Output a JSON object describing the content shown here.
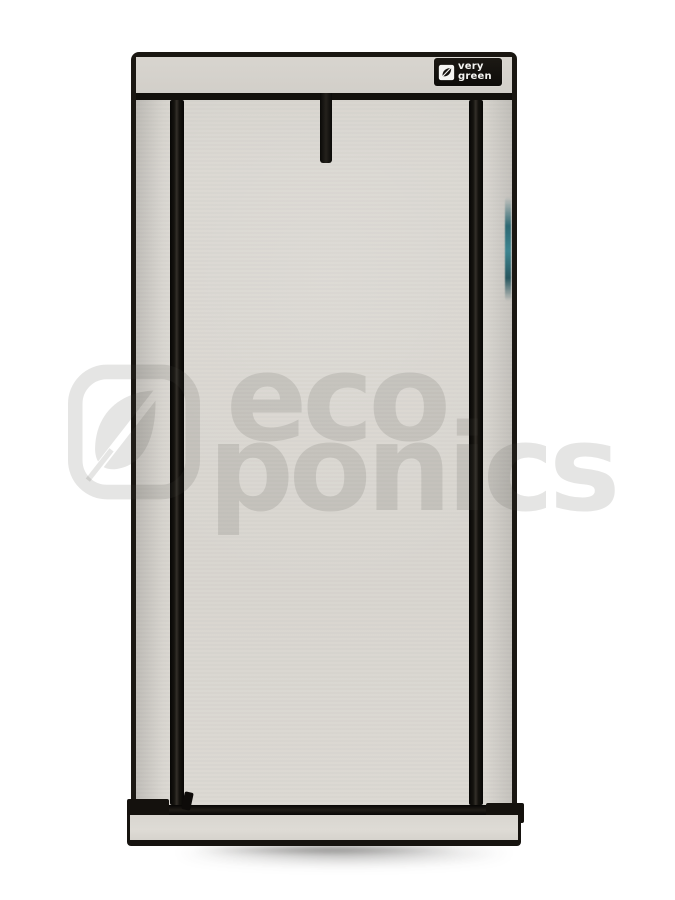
{
  "product_image": {
    "description": "grow tent product photo",
    "brand_patch": {
      "line1": "very",
      "line2": "green",
      "icon": "leaf-checkbox-icon",
      "bg_color": "#15120e",
      "text_color": "#f5f5f2"
    },
    "watermark": {
      "line1": "eco",
      "line2": "ponics",
      "logo": "leaf-in-rounded-square",
      "color": "rgba(70,70,64,0.14)"
    },
    "colors": {
      "background": "#ffffff",
      "fabric": "#d8d5cf",
      "trim": "#1a1712",
      "accent_teal": "#2f7f8c"
    }
  }
}
